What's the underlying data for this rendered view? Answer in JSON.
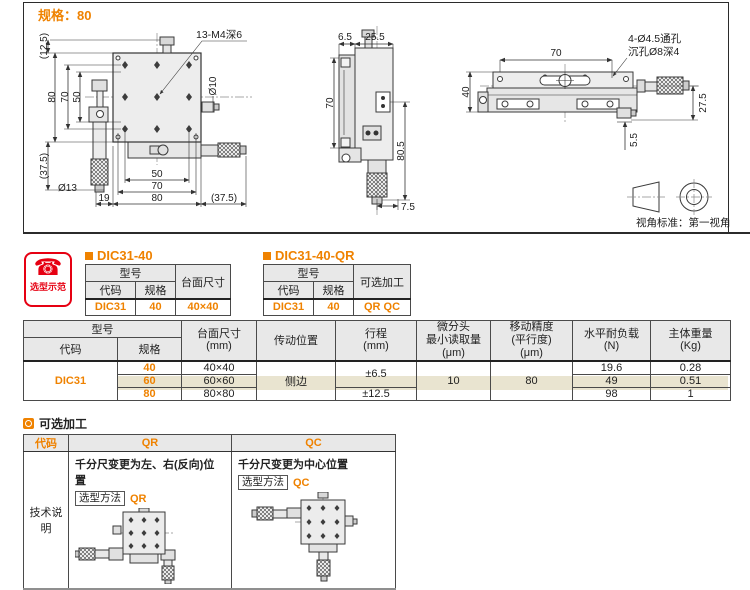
{
  "accent": "#ef8200",
  "spec_header": "规格：80",
  "icons": {
    "phone": "☎"
  },
  "selector_badge": {
    "label": "选型示范"
  },
  "drawing": {
    "front": {
      "note_thread": "13-M4深6",
      "dim_bracket_125": "(12.5)",
      "dim_v80": "80",
      "dim_v70": "70",
      "dim_v50": "50",
      "dim_v375": "(37.5)",
      "dim_dia13": "Ø13",
      "dim_dia10": "Ø10",
      "dim_b50": "50",
      "dim_b70": "70",
      "dim_b80": "80",
      "dim_b19": "19",
      "dim_b375": "(37.5)"
    },
    "side": {
      "dim_65": "6.5",
      "dim_255": "25.5",
      "dim_70": "70",
      "dim_805": "80.5",
      "dim_75": "7.5"
    },
    "top": {
      "dim_70": "70",
      "dim_40": "40",
      "dim_275": "27.5",
      "dim_55": "5.5",
      "note_hole1": "4-Ø4.5通孔",
      "note_hole2": "沉孔Ø8深4"
    },
    "projection_caption": "视角标准：第一视角"
  },
  "sample_tables": [
    {
      "title": "DIC31-40",
      "model_header": "型号",
      "col_code": "代码",
      "col_spec": "规格",
      "col_extra": "台面尺寸",
      "row": {
        "code": "DIC31",
        "spec": "40",
        "extra": "40×40"
      }
    },
    {
      "title": "DIC31-40-QR",
      "model_header": "型号",
      "col_code": "代码",
      "col_spec": "规格",
      "col_extra": "可选加工",
      "row": {
        "code": "DIC31",
        "spec": "40",
        "extra": "QR QC"
      }
    }
  ],
  "main_table": {
    "headers": {
      "model": "型号",
      "code": "代码",
      "spec": "规格",
      "size": "台面尺寸\n(mm)",
      "drive": "传动位置",
      "travel": "行程\n(mm)",
      "reading": "微分头\n最小读取量\n(μm)",
      "precision": "移动精度\n(平行度)\n(μm)",
      "load": "水平耐负载\n(N)",
      "weight": "主体重量\n(Kg)"
    },
    "code": "DIC31",
    "drive": "侧边",
    "travel_40_60": "±6.5",
    "travel_80": "±12.5",
    "reading": "10",
    "precision": "80",
    "rows": [
      {
        "spec": "40",
        "size": "40×40",
        "load": "19.6",
        "weight": "0.28"
      },
      {
        "spec": "60",
        "size": "60×60",
        "load": "49",
        "weight": "0.51"
      },
      {
        "spec": "80",
        "size": "80×80",
        "load": "98",
        "weight": "1"
      }
    ]
  },
  "options": {
    "title": "可选加工",
    "col_code": "代码",
    "col_qr": "QR",
    "col_qc": "QC",
    "row_label": "技术说明",
    "qr": {
      "desc": "千分尺变更为左、右(反向)位置",
      "method_label": "选型方法",
      "method_code": "QR"
    },
    "qc": {
      "desc": "千分尺变更为中心位置",
      "method_label": "选型方法",
      "method_code": "QC"
    }
  }
}
